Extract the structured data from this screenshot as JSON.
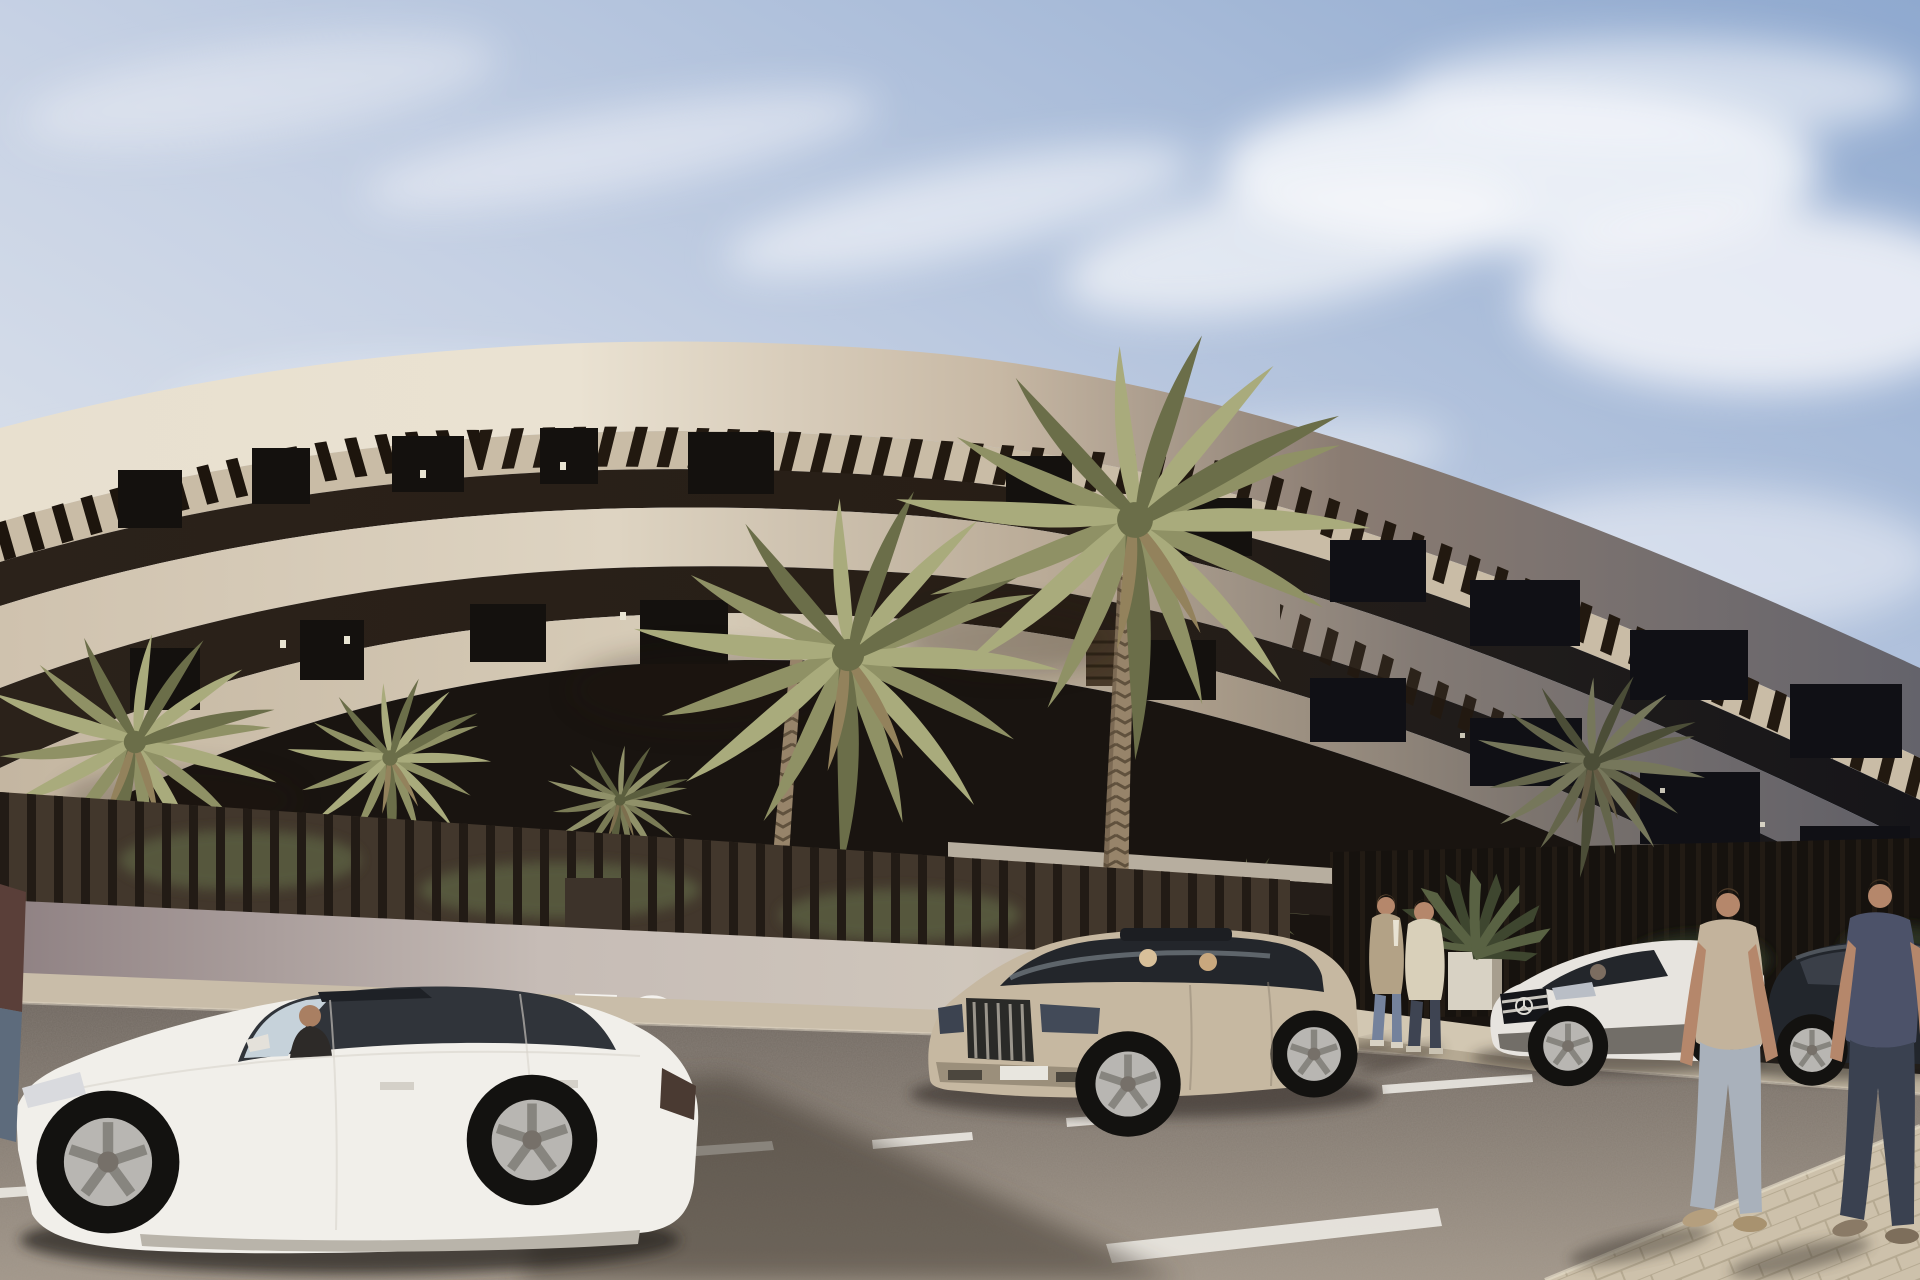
{
  "scene": {
    "type": "architectural-exterior-render",
    "wall_sign_text": "TO",
    "colors": {
      "sky_top": "#8fa9cf",
      "sky_mid": "#c6d1e4",
      "sky_low": "#edeff1",
      "cloud_white": "#f7f8fb",
      "facade_cream": "#e8e0cf",
      "facade_cream_mid": "#c9bba6",
      "facade_shadow_grey": "#6a6870",
      "recess_dark": "#2a211a",
      "recess_dark_right": "#191719",
      "soffit": "#c9bca6",
      "pergola_slat": "#221910",
      "fence_wall": "#c6bcb6",
      "fence_wall_dark": "#8e8082",
      "fence_slat": "#221b15",
      "canopy_slab_top": "#b7ae9f",
      "canopy_fascia": "#241d18",
      "sidewalk": "#c9bda9",
      "walkway": "#d2c7b2",
      "paver": "#cdc1ab",
      "paver_joint": "#b6aa92",
      "asphalt_far": "#6f6760",
      "asphalt_near": "#a2978a",
      "marking_white": "#f1efe9",
      "palm_olive": "#8f9165",
      "palm_light": "#a9ab7c",
      "palm_dark": "#6b6e49",
      "palm_dried": "#93825c",
      "trunk_brown": "#97846a",
      "car_white": "#f1efea",
      "car_champagne": "#c6b8a1",
      "car_mercedes": "#e7e4df",
      "car_dark_sedan": "#22262c",
      "glass_dark": "#2b2f35",
      "skin": "#b5876b",
      "tee_tan": "#c3b39c",
      "tee_navy": "#4c5269",
      "jeans_light": "#a9b1bb",
      "jeans_dark": "#3a4150",
      "jacket_beige": "#b3a286",
      "sweater_cream": "#d9d0ba"
    }
  }
}
